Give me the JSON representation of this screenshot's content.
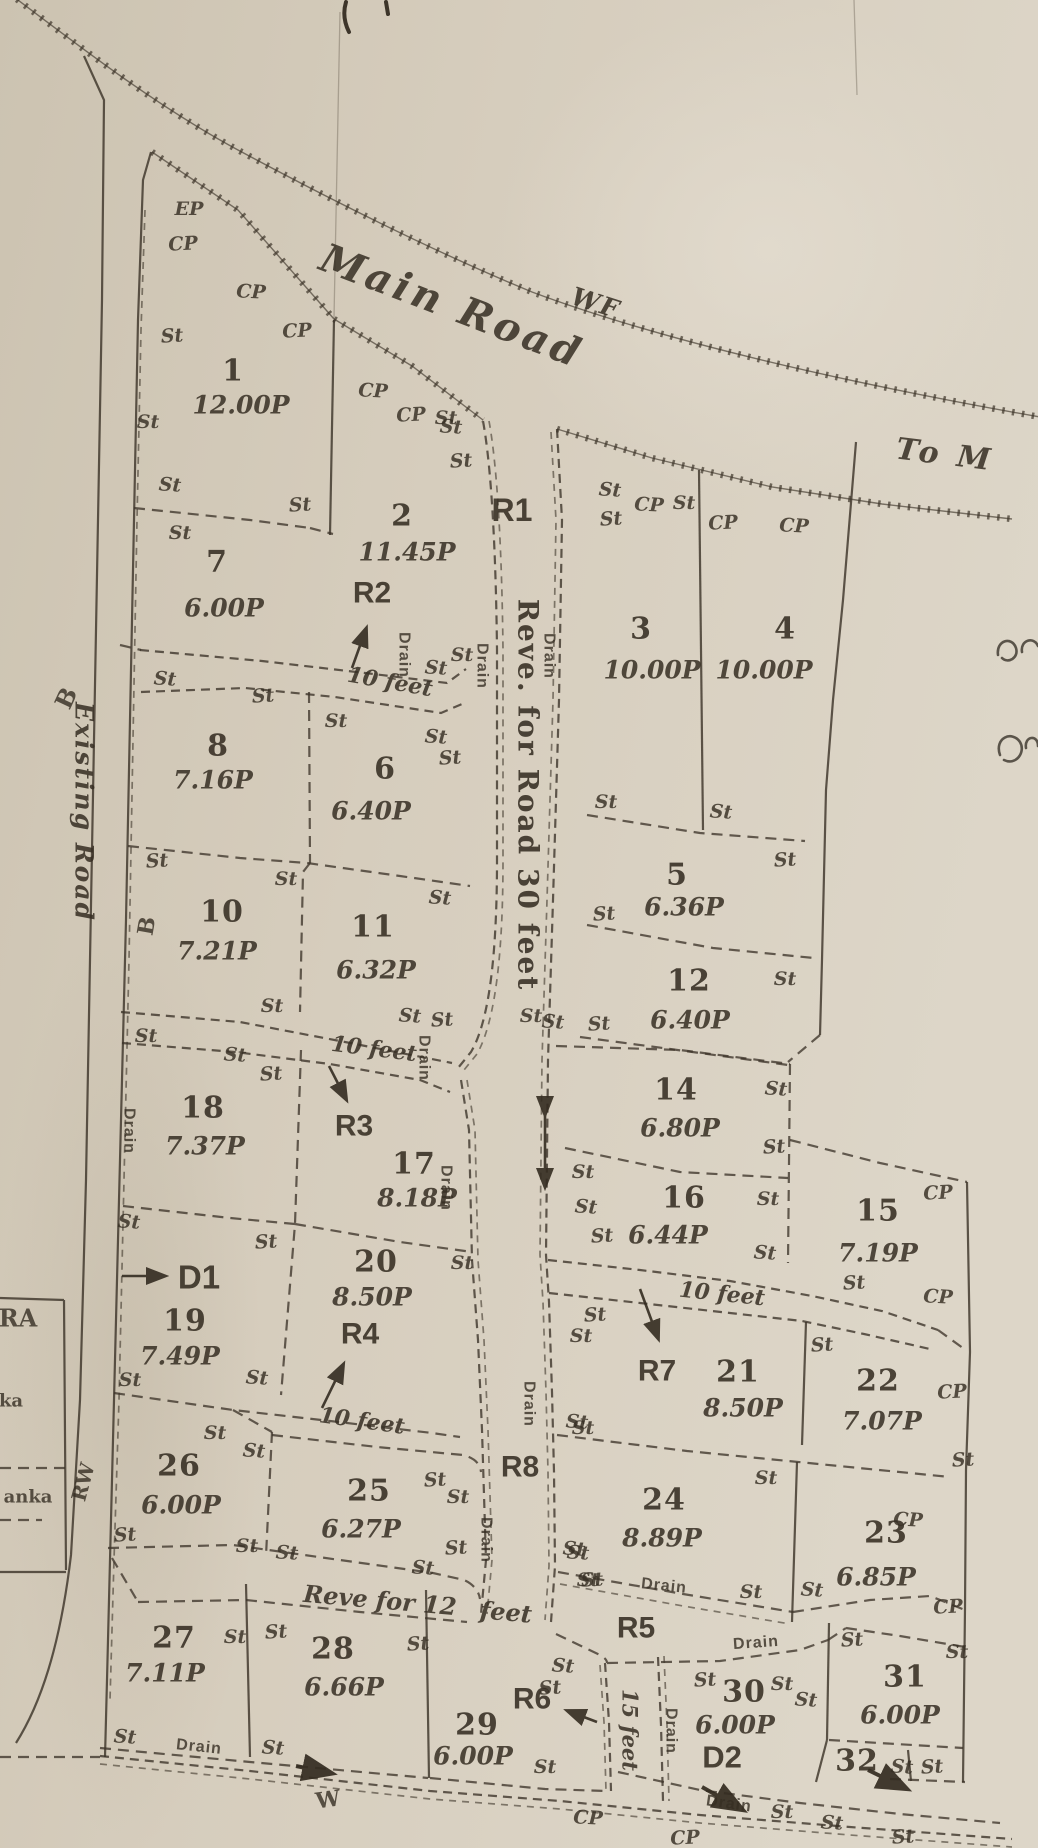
{
  "plan": {
    "paper_color": "#d6cdbd",
    "ink_color": "#3d352a",
    "marker_glyphs": {
      "st": "St",
      "cp": "CP",
      "ep": "EP",
      "drain": "Drain"
    }
  },
  "road_labels": [
    {
      "id": "main-road",
      "text": "Main Road",
      "x": 452,
      "y": 306,
      "rot": 21,
      "cls": "road"
    },
    {
      "id": "wf",
      "text": "WF",
      "x": 596,
      "y": 303,
      "rot": 18,
      "cls": "roadsm"
    },
    {
      "id": "to-m",
      "text": "To M",
      "x": 945,
      "y": 455,
      "rot": 7,
      "cls": "road",
      "size": 30
    },
    {
      "id": "existing-road",
      "text": "Existing Road",
      "x": 84,
      "y": 812,
      "rot": 90,
      "cls": "roadsm"
    },
    {
      "id": "r1-reservation-text",
      "text": "Reve. for Road 30 feet",
      "x": 528,
      "y": 795,
      "rot": 90,
      "cls": "r1t"
    },
    {
      "id": "ten-feet-1",
      "text": "10 feet",
      "x": 390,
      "y": 682,
      "rot": 10,
      "cls": "feet"
    },
    {
      "id": "ten-feet-2",
      "text": "10 feet",
      "x": 374,
      "y": 1049,
      "rot": 7,
      "cls": "feet"
    },
    {
      "id": "ten-feet-3",
      "text": "10 feet",
      "x": 722,
      "y": 1294,
      "rot": 6,
      "cls": "feet"
    },
    {
      "id": "ten-feet-4",
      "text": "10 feet",
      "x": 362,
      "y": 1421,
      "rot": 8,
      "cls": "feet"
    },
    {
      "id": "reve-12",
      "text": "Reve for 12",
      "x": 380,
      "y": 1600,
      "rot": 5,
      "cls": "feet",
      "size": 24
    },
    {
      "id": "reve-12-feet",
      "text": "feet",
      "x": 506,
      "y": 1612,
      "rot": 5,
      "cls": "feet",
      "size": 24
    },
    {
      "id": "fifteen-feet",
      "text": "15 feet",
      "x": 630,
      "y": 1730,
      "rot": 90,
      "cls": "feet",
      "size": 21
    }
  ],
  "reservation_labels": [
    {
      "id": "R1",
      "text": "R1",
      "x": 512,
      "y": 510,
      "size": 32
    },
    {
      "id": "R2",
      "text": "R2",
      "x": 372,
      "y": 593
    },
    {
      "id": "R3",
      "text": "R3",
      "x": 354,
      "y": 1126
    },
    {
      "id": "R4",
      "text": "R4",
      "x": 360,
      "y": 1334
    },
    {
      "id": "R5",
      "text": "R5",
      "x": 636,
      "y": 1628
    },
    {
      "id": "R6",
      "text": "R6",
      "x": 532,
      "y": 1699
    },
    {
      "id": "R7",
      "text": "R7",
      "x": 657,
      "y": 1371
    },
    {
      "id": "R8",
      "text": "R8",
      "x": 520,
      "y": 1467
    },
    {
      "id": "D1",
      "text": "D1",
      "x": 199,
      "y": 1277,
      "size": 33
    },
    {
      "id": "D2",
      "text": "D2",
      "x": 722,
      "y": 1757,
      "size": 31
    }
  ],
  "plots": [
    {
      "no": "1",
      "area": "12.00P",
      "nx": 233,
      "ny": 371,
      "ax": 241,
      "ay": 405
    },
    {
      "no": "2",
      "area": "11.45P",
      "nx": 402,
      "ny": 516,
      "ax": 407,
      "ay": 552
    },
    {
      "no": "3",
      "area": "10.00P",
      "nx": 641,
      "ny": 629,
      "ax": 652,
      "ay": 670
    },
    {
      "no": "4",
      "area": "10.00P",
      "nx": 785,
      "ny": 629,
      "ax": 764,
      "ay": 670
    },
    {
      "no": "5",
      "area": "6.36P",
      "nx": 677,
      "ny": 875,
      "ax": 684,
      "ay": 907
    },
    {
      "no": "6",
      "area": "6.40P",
      "nx": 385,
      "ny": 769,
      "ax": 371,
      "ay": 811
    },
    {
      "no": "7",
      "area": "6.00P",
      "nx": 217,
      "ny": 562,
      "ax": 224,
      "ay": 608
    },
    {
      "no": "8",
      "area": "7.16P",
      "nx": 218,
      "ny": 746,
      "ax": 213,
      "ay": 780
    },
    {
      "no": "10",
      "area": "7.21P",
      "nx": 222,
      "ny": 912,
      "ax": 217,
      "ay": 951
    },
    {
      "no": "11",
      "area": "6.32P",
      "nx": 373,
      "ny": 927,
      "ax": 376,
      "ay": 970
    },
    {
      "no": "12",
      "area": "6.40P",
      "nx": 689,
      "ny": 981,
      "ax": 690,
      "ay": 1020
    },
    {
      "no": "14",
      "area": "6.80P",
      "nx": 676,
      "ny": 1090,
      "ax": 680,
      "ay": 1128
    },
    {
      "no": "15",
      "area": "7.19P",
      "nx": 878,
      "ny": 1211,
      "ax": 878,
      "ay": 1253
    },
    {
      "no": "16",
      "area": "6.44P",
      "nx": 684,
      "ny": 1198,
      "ax": 668,
      "ay": 1235
    },
    {
      "no": "17",
      "area": "8.18P",
      "nx": 414,
      "ny": 1164,
      "ax": 417,
      "ay": 1198
    },
    {
      "no": "18",
      "area": "7.37P",
      "nx": 203,
      "ny": 1108,
      "ax": 205,
      "ay": 1146
    },
    {
      "no": "19",
      "area": "7.49P",
      "nx": 185,
      "ny": 1321,
      "ax": 180,
      "ay": 1356
    },
    {
      "no": "20",
      "area": "8.50P",
      "nx": 376,
      "ny": 1262,
      "ax": 372,
      "ay": 1297
    },
    {
      "no": "21",
      "area": "8.50P",
      "nx": 738,
      "ny": 1372,
      "ax": 743,
      "ay": 1408
    },
    {
      "no": "22",
      "area": "7.07P",
      "nx": 878,
      "ny": 1381,
      "ax": 882,
      "ay": 1421
    },
    {
      "no": "23",
      "area": "6.85P",
      "nx": 886,
      "ny": 1533,
      "ax": 876,
      "ay": 1577
    },
    {
      "no": "24",
      "area": "8.89P",
      "nx": 664,
      "ny": 1500,
      "ax": 662,
      "ay": 1538
    },
    {
      "no": "25",
      "area": "6.27P",
      "nx": 369,
      "ny": 1491,
      "ax": 361,
      "ay": 1529
    },
    {
      "no": "26",
      "area": "6.00P",
      "nx": 179,
      "ny": 1466,
      "ax": 181,
      "ay": 1505
    },
    {
      "no": "27",
      "area": "7.11P",
      "nx": 174,
      "ny": 1638,
      "ax": 165,
      "ay": 1673
    },
    {
      "no": "28",
      "area": "6.66P",
      "nx": 333,
      "ny": 1649,
      "ax": 344,
      "ay": 1687
    },
    {
      "no": "29",
      "area": "6.00P",
      "nx": 477,
      "ny": 1725,
      "ax": 473,
      "ay": 1756
    },
    {
      "no": "30",
      "area": "6.00P",
      "nx": 744,
      "ny": 1692,
      "ax": 735,
      "ay": 1725
    },
    {
      "no": "31",
      "area": "6.00P",
      "nx": 905,
      "ny": 1677,
      "ax": 900,
      "ay": 1715
    },
    {
      "no": "32",
      "nx": 857,
      "ny": 1761
    }
  ],
  "markers": {
    "st": [
      [
        172,
        336
      ],
      [
        148,
        422
      ],
      [
        170,
        485
      ],
      [
        300,
        505
      ],
      [
        180,
        533
      ],
      [
        451,
        427
      ],
      [
        461,
        461
      ],
      [
        446,
        418
      ],
      [
        610,
        490
      ],
      [
        611,
        519
      ],
      [
        684,
        503
      ],
      [
        165,
        679
      ],
      [
        263,
        696
      ],
      [
        336,
        721
      ],
      [
        436,
        737
      ],
      [
        450,
        758
      ],
      [
        462,
        655
      ],
      [
        436,
        668
      ],
      [
        157,
        861
      ],
      [
        286,
        879
      ],
      [
        440,
        898
      ],
      [
        604,
        914
      ],
      [
        606,
        802
      ],
      [
        721,
        812
      ],
      [
        785,
        860
      ],
      [
        272,
        1006
      ],
      [
        410,
        1016
      ],
      [
        442,
        1020
      ],
      [
        146,
        1036
      ],
      [
        235,
        1055
      ],
      [
        271,
        1074
      ],
      [
        531,
        1016
      ],
      [
        553,
        1022
      ],
      [
        599,
        1024
      ],
      [
        785,
        979
      ],
      [
        129,
        1222
      ],
      [
        266,
        1242
      ],
      [
        462,
        1263
      ],
      [
        776,
        1089
      ],
      [
        774,
        1147
      ],
      [
        583,
        1172
      ],
      [
        586,
        1207
      ],
      [
        602,
        1236
      ],
      [
        768,
        1199
      ],
      [
        765,
        1253
      ],
      [
        854,
        1283
      ],
      [
        130,
        1380
      ],
      [
        257,
        1378
      ],
      [
        595,
        1315
      ],
      [
        581,
        1336
      ],
      [
        577,
        1422
      ],
      [
        822,
        1345
      ],
      [
        215,
        1433
      ],
      [
        254,
        1451
      ],
      [
        125,
        1535
      ],
      [
        247,
        1546
      ],
      [
        287,
        1553
      ],
      [
        435,
        1480
      ],
      [
        458,
        1497
      ],
      [
        423,
        1568
      ],
      [
        456,
        1548
      ],
      [
        583,
        1428
      ],
      [
        578,
        1553
      ],
      [
        963,
        1460
      ],
      [
        766,
        1478
      ],
      [
        574,
        1549
      ],
      [
        592,
        1580
      ],
      [
        751,
        1592
      ],
      [
        812,
        1590
      ],
      [
        276,
        1632
      ],
      [
        235,
        1637
      ],
      [
        125,
        1737
      ],
      [
        418,
        1644
      ],
      [
        588,
        1580
      ],
      [
        563,
        1666
      ],
      [
        550,
        1688
      ],
      [
        545,
        1767
      ],
      [
        273,
        1748
      ],
      [
        705,
        1680
      ],
      [
        782,
        1684
      ],
      [
        806,
        1700
      ],
      [
        852,
        1640
      ],
      [
        957,
        1652
      ],
      [
        902,
        1767
      ],
      [
        932,
        1767
      ],
      [
        782,
        1812
      ],
      [
        832,
        1823
      ],
      [
        903,
        1837
      ]
    ],
    "cp": [
      [
        183,
        244
      ],
      [
        251,
        292
      ],
      [
        297,
        331
      ],
      [
        373,
        391
      ],
      [
        411,
        415
      ],
      [
        649,
        505
      ],
      [
        723,
        523
      ],
      [
        794,
        526
      ],
      [
        938,
        1193
      ],
      [
        938,
        1297
      ],
      [
        952,
        1392
      ],
      [
        908,
        1520
      ],
      [
        948,
        1607
      ],
      [
        588,
        1818
      ],
      [
        685,
        1838
      ]
    ],
    "ep": [
      [
        189,
        209
      ]
    ],
    "drain": [
      [
        404,
        655,
        90
      ],
      [
        482,
        666,
        90
      ],
      [
        549,
        656,
        90
      ],
      [
        424,
        1058,
        90
      ],
      [
        446,
        1188,
        90
      ],
      [
        129,
        1131,
        90
      ],
      [
        529,
        1404,
        90
      ],
      [
        486,
        1540,
        90
      ],
      [
        671,
        1731,
        90
      ],
      [
        664,
        1586,
        6
      ],
      [
        756,
        1643,
        -4
      ],
      [
        199,
        1747,
        6
      ],
      [
        729,
        1804,
        8
      ]
    ]
  },
  "edge_labels": [
    {
      "id": "b-upper",
      "text": "B",
      "x": 66,
      "y": 698,
      "rot": -65,
      "size": 24
    },
    {
      "id": "b-lower",
      "text": "B",
      "x": 147,
      "y": 926,
      "rot": -80,
      "size": 22
    },
    {
      "id": "rw",
      "text": "RW",
      "x": 83,
      "y": 1482,
      "rot": -75,
      "size": 20
    },
    {
      "id": "ra",
      "text": "RA",
      "x": 18,
      "y": 1318,
      "rot": 0,
      "size": 24
    },
    {
      "id": "ka",
      "text": "ka",
      "x": 11,
      "y": 1401,
      "rot": 0,
      "size": 18
    },
    {
      "id": "anka",
      "text": "anka",
      "x": 28,
      "y": 1497,
      "rot": 0,
      "size": 18
    },
    {
      "id": "w-bottom",
      "text": "W",
      "x": 328,
      "y": 1800,
      "rot": -8,
      "size": 22
    }
  ],
  "marginalia": [
    {
      "id": "sinhala-fragment-1",
      "text": "ගො"
    },
    {
      "id": "sinhala-fragment-2",
      "text": "තු"
    }
  ]
}
